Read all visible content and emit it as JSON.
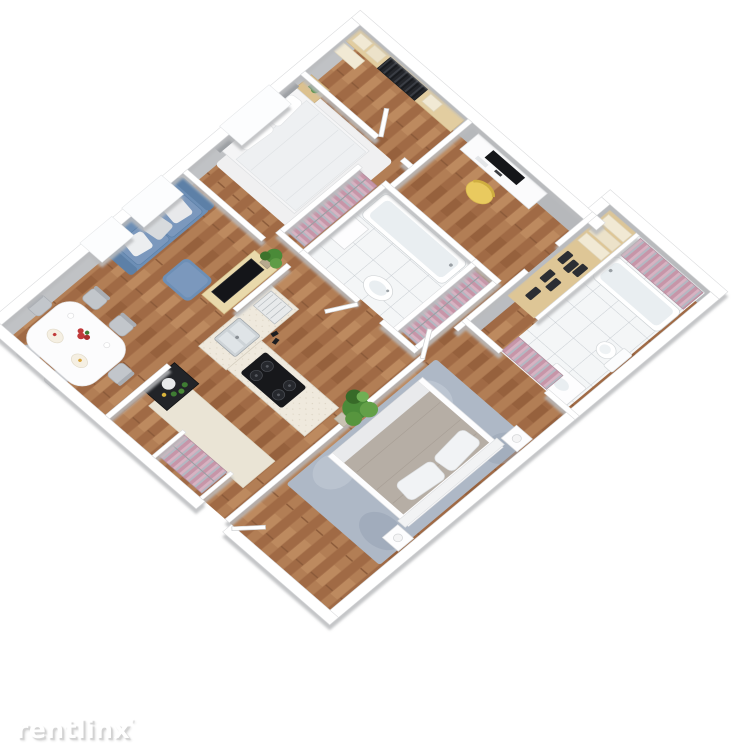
{
  "page": {
    "background": "#ffffff",
    "content": "isometric 3D apartment floor plan render"
  },
  "watermark": {
    "text": "rentlinx",
    "mark": "ʹ"
  },
  "floor_plan": {
    "type": "isometric-3d-render",
    "rooms": [
      {
        "id": "walk-in-closet",
        "features": [
          "wood-shelving",
          "linen-stacks",
          "dark-hanging-clothes",
          "door"
        ]
      },
      {
        "id": "bedroom-1",
        "features": [
          "double-bed",
          "gray-headboard",
          "white-rug",
          "nightstand-with-plant",
          "window"
        ]
      },
      {
        "id": "office-nook",
        "features": [
          "white-desk",
          "black-monitor",
          "yellow-chair"
        ]
      },
      {
        "id": "bathroom-1",
        "features": [
          "bathtub",
          "white-tile-floor",
          "oval-sink",
          "white-cabinet",
          "pink-wardrobe-left",
          "pink-wardrobe-right"
        ]
      },
      {
        "id": "bathroom-2",
        "features": [
          "bathtub",
          "white-tile-floor",
          "toilet",
          "vanity-sink",
          "linen-shelves",
          "pink-wardrobe-top",
          "pink-wardrobe-bottom"
        ]
      },
      {
        "id": "living-room",
        "features": [
          "blue-sofa",
          "white-pillows",
          "blue-ottoman",
          "tv-stand",
          "tv",
          "potted-plant",
          "windows"
        ]
      },
      {
        "id": "dining-area",
        "features": [
          "white-table",
          "gray-chairs",
          "red-flowers",
          "plates"
        ]
      },
      {
        "id": "kitchen",
        "features": [
          "l-shaped-counter",
          "stainless-sink",
          "dish-rack",
          "gas-cooktop",
          "large-potted-plant"
        ]
      },
      {
        "id": "entry-hall",
        "features": [
          "beige-runner-carpet",
          "dark-cabinet",
          "pink-wardrobe",
          "entry-door"
        ]
      },
      {
        "id": "bedroom-2",
        "features": [
          "double-bed",
          "taupe-duvet",
          "white-pillows",
          "blue-gray-rug",
          "nightstands-with-lamps",
          "pink-wardrobe"
        ]
      }
    ],
    "palette": {
      "background": "#ffffff",
      "wall_top": "#ffffff",
      "wall_face": "#b6b8bb",
      "wood_floor": "#a9744d",
      "light_wood": "#e2cda0",
      "tile": "#f4f6f7",
      "sofa_blue": "#6d8fb6",
      "bed2_duvet": "#b6aea5",
      "wardrobe_pink": "#c795a8",
      "kitchen_counter": "#efe9dd",
      "chair_yellow": "#e9ca5f",
      "plant_green": "#4a8a38",
      "flower_red": "#c03a3a",
      "rug_blue_gray": "#aeb8c6",
      "carpet_beige": "#eae4d5",
      "appliance_dark": "#17181b"
    }
  }
}
